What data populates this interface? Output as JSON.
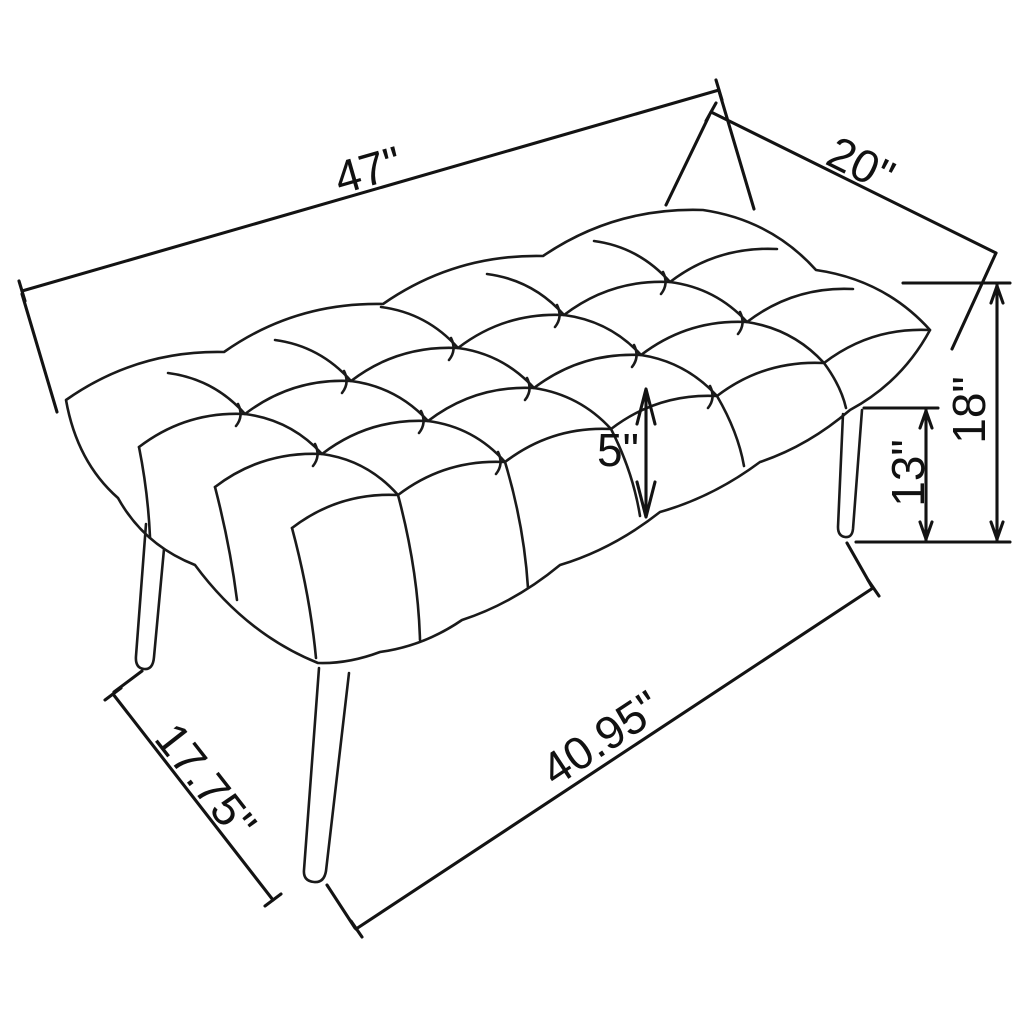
{
  "diagram": {
    "kind": "furniture-dimension-diagram",
    "background_color": "#ffffff",
    "line_color": "#1a1a1a",
    "labels": {
      "overall_length": "47\"",
      "overall_depth": "20\"",
      "overall_height": "18\"",
      "floor_to_seat_underside": "13\"",
      "cushion_thickness": "5\"",
      "leg_span_length": "40.95\"",
      "leg_span_depth": "17.75\""
    }
  }
}
